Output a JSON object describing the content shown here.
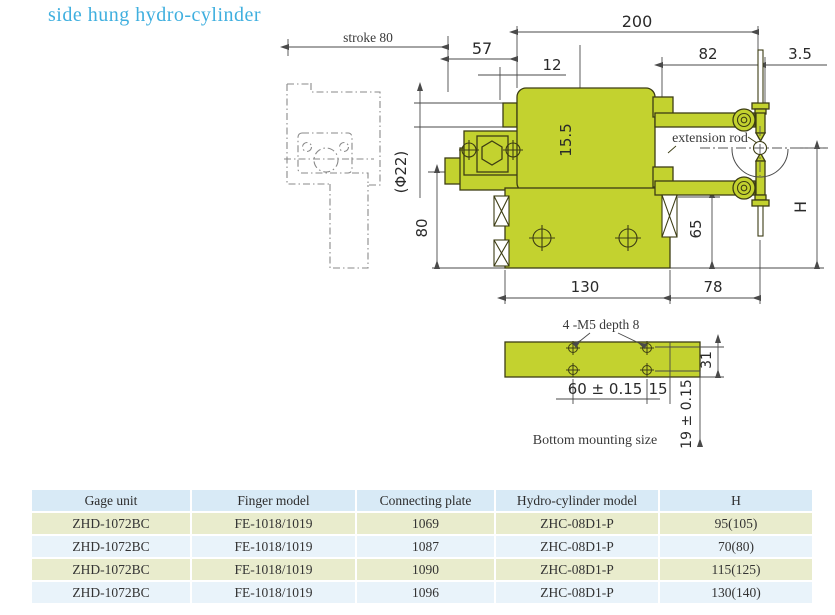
{
  "title": "side hung hydro-cylinder",
  "colors": {
    "title_blue": "#3fafdf",
    "drawing_green": "#c3d22f",
    "outline_dark": "#3d3d14",
    "table_header_bg": "#d8eaf6",
    "table_row_green": "#e9eccd",
    "table_row_blue": "#e9f3fa"
  },
  "diagram": {
    "dims": {
      "stroke": "stroke 80",
      "w57": "57",
      "w200": "200",
      "w12": "12",
      "w82": "82",
      "w3_5": "3.5",
      "h15_5": "15.5",
      "phi22": "(Φ22)",
      "h80": "80",
      "h65": "65",
      "hH": "H",
      "w130": "130",
      "w78": "78",
      "m5": "4 -M5 depth 8",
      "h31": "31",
      "w60": "60 ± 0.15",
      "w15": "15",
      "h19": "19 ± 0.15"
    },
    "labels": {
      "extension_rod": "extension rod",
      "bottom_mounting": "Bottom mounting size"
    }
  },
  "table": {
    "headers": [
      "Gage unit",
      "Finger model",
      "Connecting plate",
      "Hydro-cylinder model",
      "H"
    ],
    "rows": [
      [
        "ZHD-1072BC",
        "FE-1018/1019",
        "1069",
        "ZHC-08D1-P",
        "95(105)"
      ],
      [
        "ZHD-1072BC",
        "FE-1018/1019",
        "1087",
        "ZHC-08D1-P",
        "70(80)"
      ],
      [
        "ZHD-1072BC",
        "FE-1018/1019",
        "1090",
        "ZHC-08D1-P",
        "115(125)"
      ],
      [
        "ZHD-1072BC",
        "FE-1018/1019",
        "1096",
        "ZHC-08D1-P",
        "130(140)"
      ]
    ]
  }
}
